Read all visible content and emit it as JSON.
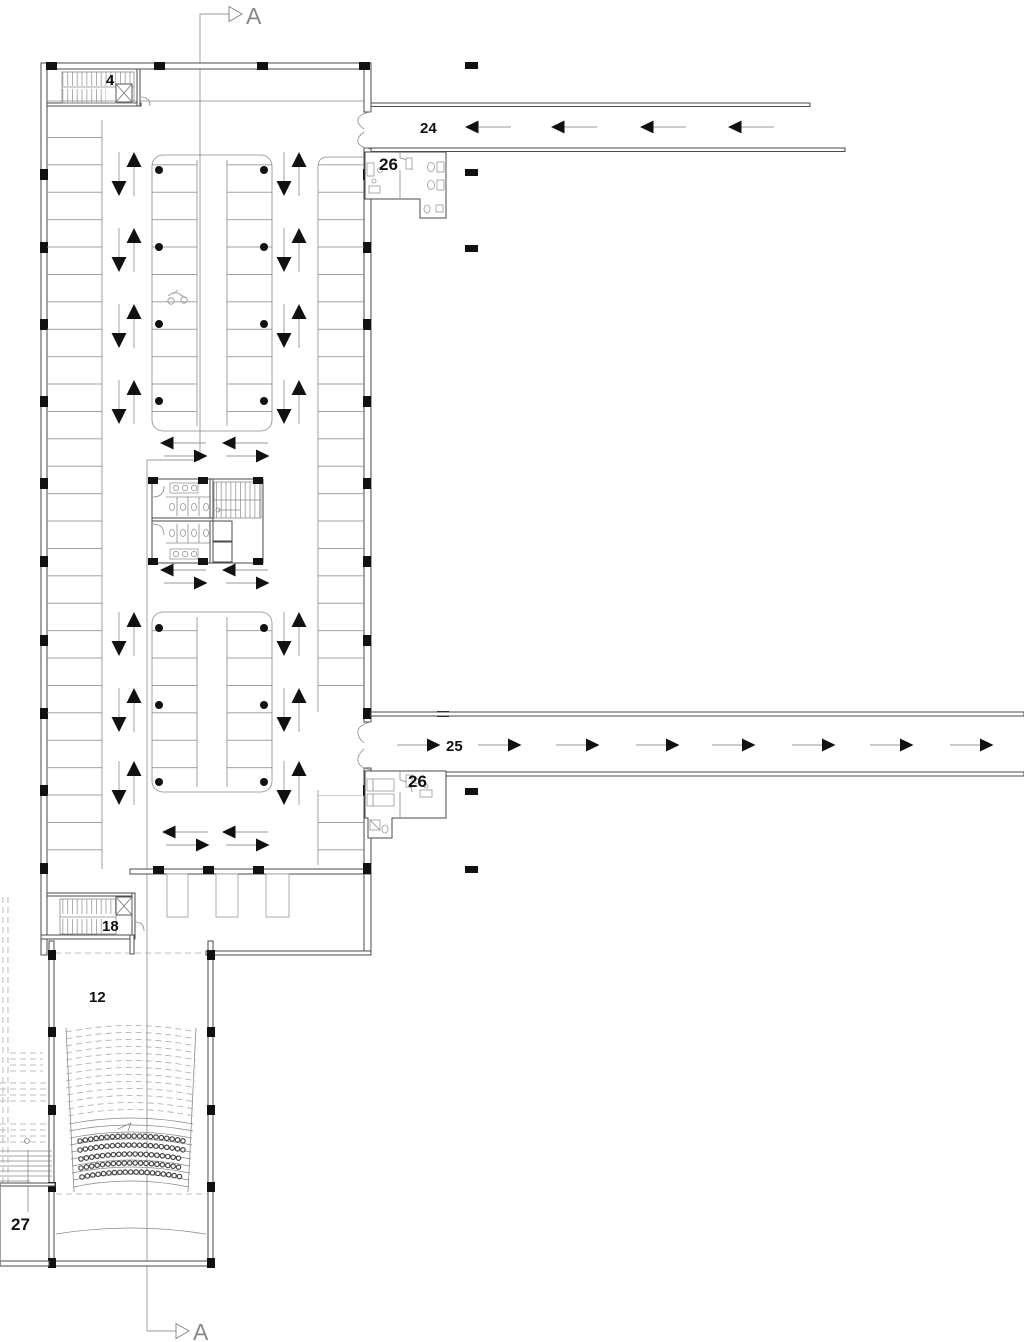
{
  "plan": {
    "type": "architectural-floor-plan",
    "section_markers": {
      "top": "A",
      "bottom": "A"
    },
    "labels": {
      "stair_north": "4",
      "corridor_north": "24",
      "suite_north": "26",
      "corridor_east": "25",
      "suite_east": "26",
      "stair_south": "18",
      "auditorium": "12",
      "side_room": "27"
    },
    "icons": {
      "flow_up": "traffic-arrow-up",
      "flow_down": "traffic-arrow-down",
      "flow_left": "traffic-arrow-left",
      "flow_right": "traffic-arrow-right",
      "section_cut": "section-cut-triangle",
      "elevator": "elevator-x-icon",
      "stair": "stair-treads-icon",
      "motorcycle": "motorcycle-icon",
      "toilet": "toilet-icon",
      "sink": "sink-icon",
      "seats": "theater-seat-dots"
    },
    "colors": {
      "background": "#ffffff",
      "wall": "#4a4a4a",
      "thin_line": "#8a8a8a",
      "light_line": "#bbbbbb",
      "solid_black": "#111111",
      "section_line": "#999999",
      "label_text": "#111111",
      "section_text": "#888888"
    }
  }
}
